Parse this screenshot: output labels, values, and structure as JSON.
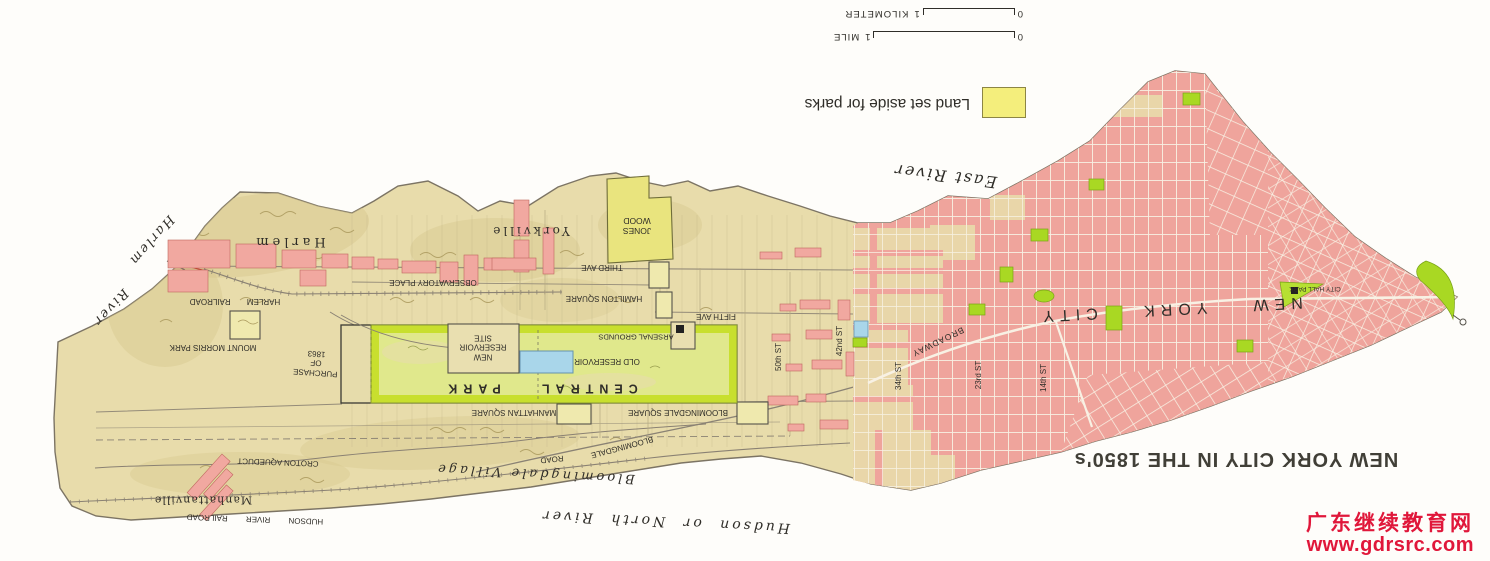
{
  "title": "NEW YORK CITY IN THE 1850's",
  "legend": {
    "label": "Land set aside for parks",
    "swatch_color": "#f4ee7c"
  },
  "scale": {
    "mile": {
      "zero": "0",
      "one": "1",
      "unit": "MILE"
    },
    "kilometer": {
      "zero": "0",
      "one": "1",
      "unit": "KILOMETER"
    }
  },
  "watermark": {
    "line1": "广东继续教育网",
    "line2": "www.gdrsrc.com",
    "color": "#e0173a"
  },
  "orientation_note": "map artwork rotated 180 degrees",
  "colors": {
    "land_tan": "#e8dcab",
    "city_block_pink": "#efa49c",
    "street_white": "#f8f1e4",
    "park_bright_green": "#a9d823",
    "central_park_green": "#c8df2e",
    "reserved_yellow": "#efe9ae",
    "reservoir_blue": "#a9d6ea",
    "text": "#2f2d28",
    "outline": "#7c7464"
  },
  "labels": [
    {
      "id": "harlem-town",
      "t": "Harlem",
      "x": 289,
      "y": 241,
      "r": 180,
      "fs": 13,
      "ls": 4,
      "sf": 1
    },
    {
      "id": "yorkville",
      "t": "Yorkville",
      "x": 530,
      "y": 231,
      "r": 180,
      "fs": 12,
      "ls": 3,
      "sf": 1
    },
    {
      "id": "manhattanville",
      "t": "Manhattanville",
      "x": 203,
      "y": 500,
      "r": 180,
      "fs": 11,
      "ls": 1,
      "sf": 1
    },
    {
      "id": "bloomingdale-village",
      "t": "Bloomingdale Village",
      "x": 535,
      "y": 473,
      "r": 183,
      "fs": 13,
      "ls": 3,
      "sf": 1,
      "it": 1
    },
    {
      "id": "harlem-river-word1",
      "t": "Harlem",
      "x": 151,
      "y": 240,
      "r": 131,
      "fs": 13,
      "ls": 2,
      "sf": 1,
      "it": 1
    },
    {
      "id": "harlem-river-word2",
      "t": "River",
      "x": 110,
      "y": 307,
      "r": 133,
      "fs": 13,
      "ls": 2,
      "sf": 1,
      "it": 1
    },
    {
      "id": "east-river",
      "t": "East River",
      "x": 945,
      "y": 176,
      "r": 187,
      "fs": 16,
      "ls": 2,
      "sf": 1,
      "it": 1
    },
    {
      "id": "hudson-or-north-river",
      "t": "Hudson or North River",
      "x": 665,
      "y": 521,
      "r": 183,
      "fs": 14,
      "ls": 3,
      "ws": 8,
      "sf": 1,
      "it": 1
    },
    {
      "id": "jones-wood",
      "t": "JONES\nWOOD",
      "x": 637,
      "y": 226,
      "r": 180,
      "fs": 8.5
    },
    {
      "id": "third-ave",
      "t": "THIRD AVE",
      "x": 602,
      "y": 267,
      "r": 180,
      "fs": 8
    },
    {
      "id": "observatory-place",
      "t": "OBSERVATORY PLACE",
      "x": 433,
      "y": 282,
      "r": 180,
      "fs": 8
    },
    {
      "id": "hamilton-square",
      "t": "HAMILTON SQUARE",
      "x": 604,
      "y": 298,
      "r": 180,
      "fs": 8
    },
    {
      "id": "harlem-railroad",
      "t": "HARLEM RAILROAD",
      "x": 235,
      "y": 301,
      "r": 180,
      "fs": 8,
      "ws": 14
    },
    {
      "id": "fifth-ave",
      "t": "FIFTH AVE",
      "x": 716,
      "y": 316,
      "r": 180,
      "fs": 8
    },
    {
      "id": "mount-morris-park",
      "t": "MOUNT MORRIS PARK",
      "x": 213,
      "y": 347,
      "r": 180,
      "fs": 8
    },
    {
      "id": "purchase-of-1863",
      "t": "PURCHASE\nOF\n1863",
      "x": 316,
      "y": 363,
      "r": 184,
      "fs": 8
    },
    {
      "id": "new-reservoir-site",
      "t": "NEW\nRESERVOIR\nSITE",
      "x": 483,
      "y": 347,
      "r": 180,
      "fs": 8
    },
    {
      "id": "old-reservoir",
      "t": "OLD RESERVOIR",
      "x": 607,
      "y": 361,
      "r": 180,
      "fs": 8
    },
    {
      "id": "arsenal-grounds",
      "t": "ARSENAL GROUNDS",
      "x": 636,
      "y": 337,
      "r": 180,
      "fs": 7.5
    },
    {
      "id": "central-park",
      "t": "CENTRAL PARK",
      "x": 540,
      "y": 388,
      "r": 180,
      "fs": 12.5,
      "ls": 6,
      "ws": 26,
      "b": 1
    },
    {
      "id": "manhattan-square",
      "t": "MANHATTAN SQUARE",
      "x": 514,
      "y": 412,
      "r": 180,
      "fs": 8
    },
    {
      "id": "bloomingdale-square",
      "t": "BLOOMINGDALE SQUARE",
      "x": 678,
      "y": 412,
      "r": 180,
      "fs": 8
    },
    {
      "id": "bloomingdale-road-w1",
      "t": "BLOOMINGDALE",
      "x": 622,
      "y": 447,
      "r": 165,
      "fs": 8
    },
    {
      "id": "bloomingdale-road-w2",
      "t": "ROAD",
      "x": 552,
      "y": 459,
      "r": 174,
      "fs": 8
    },
    {
      "id": "croton-aqueduct",
      "t": "CROTON AQUEDUCT",
      "x": 278,
      "y": 462,
      "r": 182,
      "fs": 8
    },
    {
      "id": "hudson-river-railroad",
      "t": "HUDSON RIVER RAILROAD",
      "x": 255,
      "y": 519,
      "r": 182,
      "fs": 8,
      "ws": 16
    },
    {
      "id": "broadway",
      "t": "BROADWAY",
      "x": 938,
      "y": 342,
      "r": 154,
      "fs": 8.5,
      "ls": 1
    },
    {
      "id": "street-50th",
      "t": "50th ST",
      "x": 779,
      "y": 357,
      "r": -90,
      "fs": 8
    },
    {
      "id": "street-42nd",
      "t": "42nd ST",
      "x": 840,
      "y": 341,
      "r": -90,
      "fs": 8
    },
    {
      "id": "street-34th",
      "t": "34th ST",
      "x": 899,
      "y": 376,
      "r": -90,
      "fs": 8
    },
    {
      "id": "street-23rd",
      "t": "23rd ST",
      "x": 979,
      "y": 375,
      "r": -90,
      "fs": 8
    },
    {
      "id": "street-14th",
      "t": "14th ST",
      "x": 1044,
      "y": 378,
      "r": -90,
      "fs": 8
    },
    {
      "id": "new-york-city",
      "t": "NEW YORK CITY",
      "x": 1170,
      "y": 309,
      "r": 177,
      "fs": 16,
      "ls": 6,
      "ws": 30
    },
    {
      "id": "city-hall-park",
      "t": "CITY HALL PARK",
      "x": 1315,
      "y": 288,
      "r": 180,
      "fs": 6.5
    }
  ]
}
